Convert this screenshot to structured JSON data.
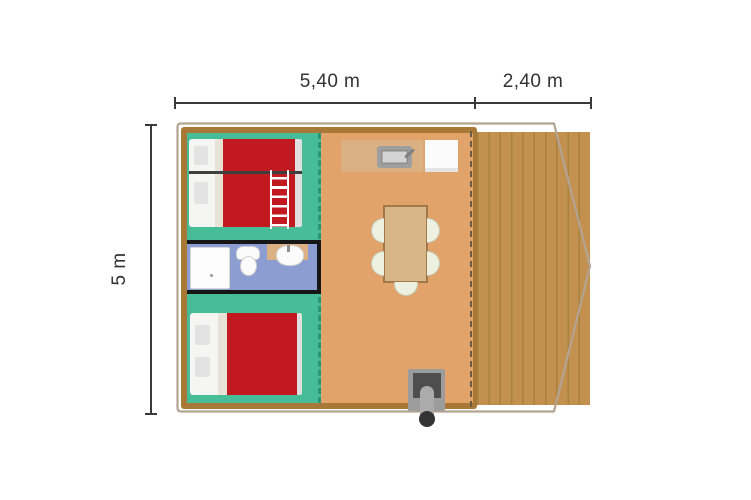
{
  "plan": {
    "type": "floor-plan",
    "dimension_labels": {
      "main_width": "5,40 m",
      "terrace_width": "2,40 m",
      "depth": "5 m"
    },
    "furniture_icons": [
      "bunk-bed-icon",
      "ladder-icon",
      "double-bed-icon",
      "shower-icon",
      "toilet-icon",
      "washbasin-icon",
      "kitchen-counter-icon",
      "kitchen-sink-icon",
      "fridge-icon",
      "dining-table-icon",
      "chair-icon",
      "stove-icon"
    ],
    "colors": {
      "bedroom_floor": "#47BD97",
      "bedroom_divider_dash": "#2D9478",
      "bathroom_floor": "#8C9ED1",
      "bathroom_wall": "#161616",
      "living_floor": "#E1A369",
      "terrace_deck": "#C2914F",
      "terrace_plank_line": "#A8813F",
      "tent_wall": "#A87936",
      "tent_front_dash": "#6F5B43",
      "bed_blanket": "#C2181F",
      "bed_sheet": "#F5F5F3",
      "bed_fold": "#E7E2D5",
      "pillow": "#E3E3E3",
      "counter_wood": "#DBB183",
      "table_wood": "#D9B687",
      "table_border": "#A0784A",
      "chair": "#EEF1DF",
      "stove_gray": "#9C9C9C",
      "stove_dark": "#4E4E4E",
      "outline_stroke": "#B3A391",
      "dimension_line": "#3A3A3A",
      "label_text": "#333333"
    }
  }
}
